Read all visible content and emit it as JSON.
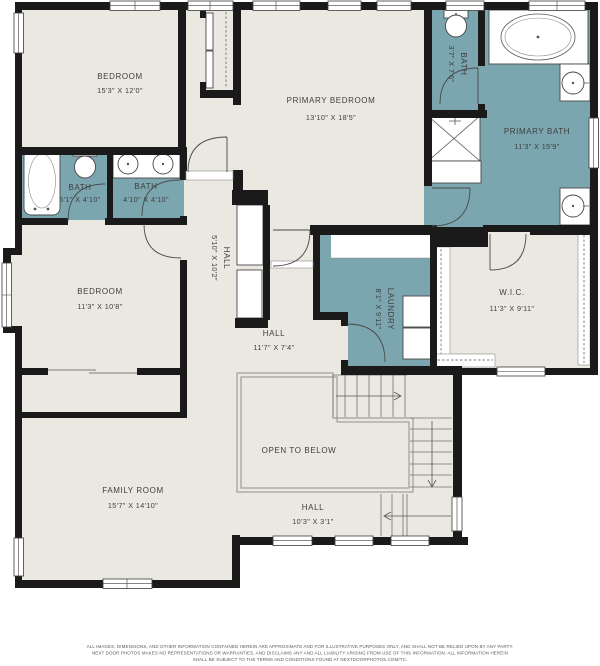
{
  "title": "Second floor residential floor plan",
  "colors": {
    "floor": "#eae8e1",
    "wet_room": "#7ba6b0",
    "wall": "#1a1a1a",
    "text": "#3e3e3e"
  },
  "rooms": {
    "bedroom1": {
      "name": "BEDROOM",
      "dims": "15'3\" X 12'0\""
    },
    "primary_bedroom": {
      "name": "PRIMARY BEDROOM",
      "dims": "13'10\" X 18'5\""
    },
    "bath_small": {
      "name": "BATH",
      "dims": "3'7\" X 7'6\""
    },
    "primary_bath": {
      "name": "PRIMARY BATH",
      "dims": "11'3\" X 15'9\""
    },
    "bath_a": {
      "name": "BATH",
      "dims": "5'1\" X 4'10\""
    },
    "bath_b": {
      "name": "BATH",
      "dims": "4'10\" X 4'10\""
    },
    "hall_upper": {
      "name": "HALL",
      "dims": "5'10\" X 10'2\""
    },
    "bedroom2": {
      "name": "BEDROOM",
      "dims": "11'3\" X 10'8\""
    },
    "hall_mid": {
      "name": "HALL",
      "dims": "11'7\" X 7'4\""
    },
    "laundry": {
      "name": "LAUNDRY",
      "dims": "8'1\" X 9'11\""
    },
    "wic": {
      "name": "W.I.C.",
      "dims": "11'3\" X 9'11\""
    },
    "family_room": {
      "name": "FAMILY ROOM",
      "dims": "15'7\" X 14'10\""
    },
    "open_below": {
      "name": "OPEN TO BELOW"
    },
    "hall_lower": {
      "name": "HALL",
      "dims": "10'3\" X 3'1\""
    }
  },
  "footer": {
    "line1": "ALL IMAGES, DIMENSIONS, AND OTHER INFORMATION CONTAINED HEREIN ARE APPROXIMATE AND FOR ILLUSTRATIVE PURPOSES ONLY, AND SHALL NOT BE RELIED UPON BY ANY PARTY.",
    "line2": "NEXT DOOR PHOTOS MAKES NO REPRESENTATIONS OR WARRANTIES, AND DISCLAIMS ANY AND ALL LIABILITY ARISING FROM USE OF THIS INFORMATION. ALL INFORMATION HEREIN",
    "line3": "SHALL BE SUBJECT TO THE TERMS AND CONDITIONS FOUND AT NEXTDOORPHOTOS.COM/TC."
  }
}
